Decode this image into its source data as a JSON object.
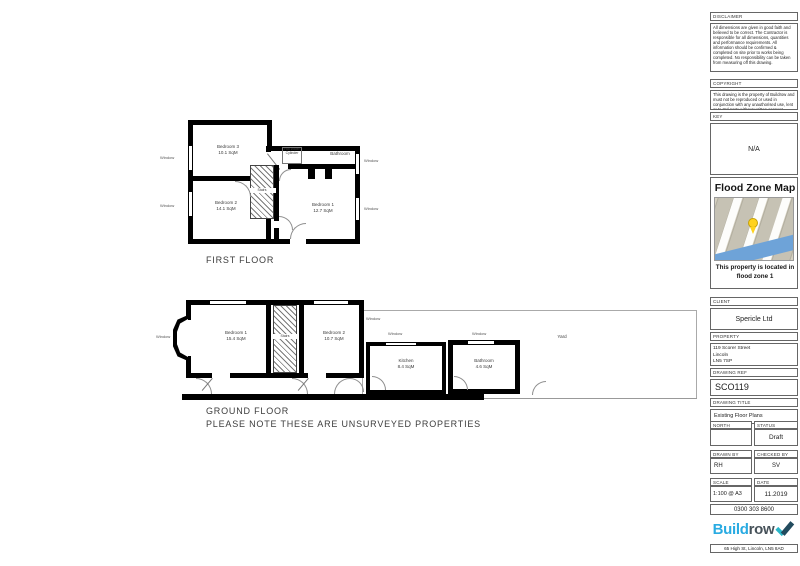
{
  "tb": {
    "disclaimer": {
      "label": "DISCLAIMER",
      "text": "All dimensions are given in good faith and believed to be correct. The Contractor is responsible for all dimensions, quantities and performance requirements. All information should be confirmed & completed on site prior to works being completed. No responsibility can be taken from measuring off this drawing."
    },
    "copyright": {
      "label": "COPYRIGHT",
      "text": "This drawing is the property of Buildrow and must not be reproduced or used in conjunction with any unauthorised use, lent or to 3rd party without written consent."
    },
    "key": {
      "label": "KEY",
      "value": "N/A"
    },
    "flood": {
      "title": "Flood Zone Map",
      "caption": "This property is located in flood zone 1"
    },
    "client": {
      "label": "CLIENT",
      "value": "Spericle Ltd"
    },
    "property": {
      "label": "PROPERTY",
      "line1": "119 Scorer Street",
      "line2": "Lincoln",
      "line3": "LN5 7SP"
    },
    "ref": {
      "label": "DRAWING REF",
      "value": "SCO119"
    },
    "drawing_title": {
      "label": "DRAWING TITLE",
      "value": "Existing Floor Plans"
    },
    "north": {
      "label": "NORTH"
    },
    "status": {
      "label": "STATUS",
      "value": "Draft"
    },
    "drawn": {
      "label": "DRAWN BY",
      "value": "RH"
    },
    "checked": {
      "label": "CHECKED BY",
      "value": "SV"
    },
    "scale": {
      "label": "SCALE",
      "value": "1:100 @ A3"
    },
    "date": {
      "label": "DATE",
      "value": "11.2019"
    },
    "phone": "0300 303 8600",
    "logo": {
      "build": "Build",
      "row": "row"
    },
    "address": "65 High St, Lincoln, LN5 8AD",
    "colors": {
      "logo_blue": "#29abe2",
      "logo_dark": "#47525a",
      "pin_yellow": "#ffd21c",
      "water_blue": "#6ea3d8"
    }
  },
  "plans": {
    "window_label": "Window",
    "stairs_label": "Stairs",
    "first": {
      "title": "FIRST FLOOR",
      "bedroom3": {
        "name": "Bedroom 3",
        "area": "10.1 SqM"
      },
      "bedroom2": {
        "name": "Bedroom 2",
        "area": "14.1 SqM"
      },
      "bedroom1": {
        "name": "Bedroom 1",
        "area": "12.7 SqM"
      },
      "bathroom": {
        "name": "Bathroom"
      },
      "cylinder": {
        "text": "Hot Water Cylinder"
      }
    },
    "ground": {
      "title": "GROUND FLOOR",
      "note": "PLEASE NOTE THESE ARE UNSURVEYED PROPERTIES",
      "bedroom1": {
        "name": "Bedroom 1",
        "area": "15.4 SqM"
      },
      "bedroom2": {
        "name": "Bedroom 2",
        "area": "10.7 SqM"
      },
      "kitchen": {
        "name": "Kitchen",
        "area": "8.4 SqM"
      },
      "bathroom": {
        "name": "Bathroom",
        "area": "4.6 SqM"
      },
      "yard": {
        "name": "Yard"
      }
    }
  }
}
